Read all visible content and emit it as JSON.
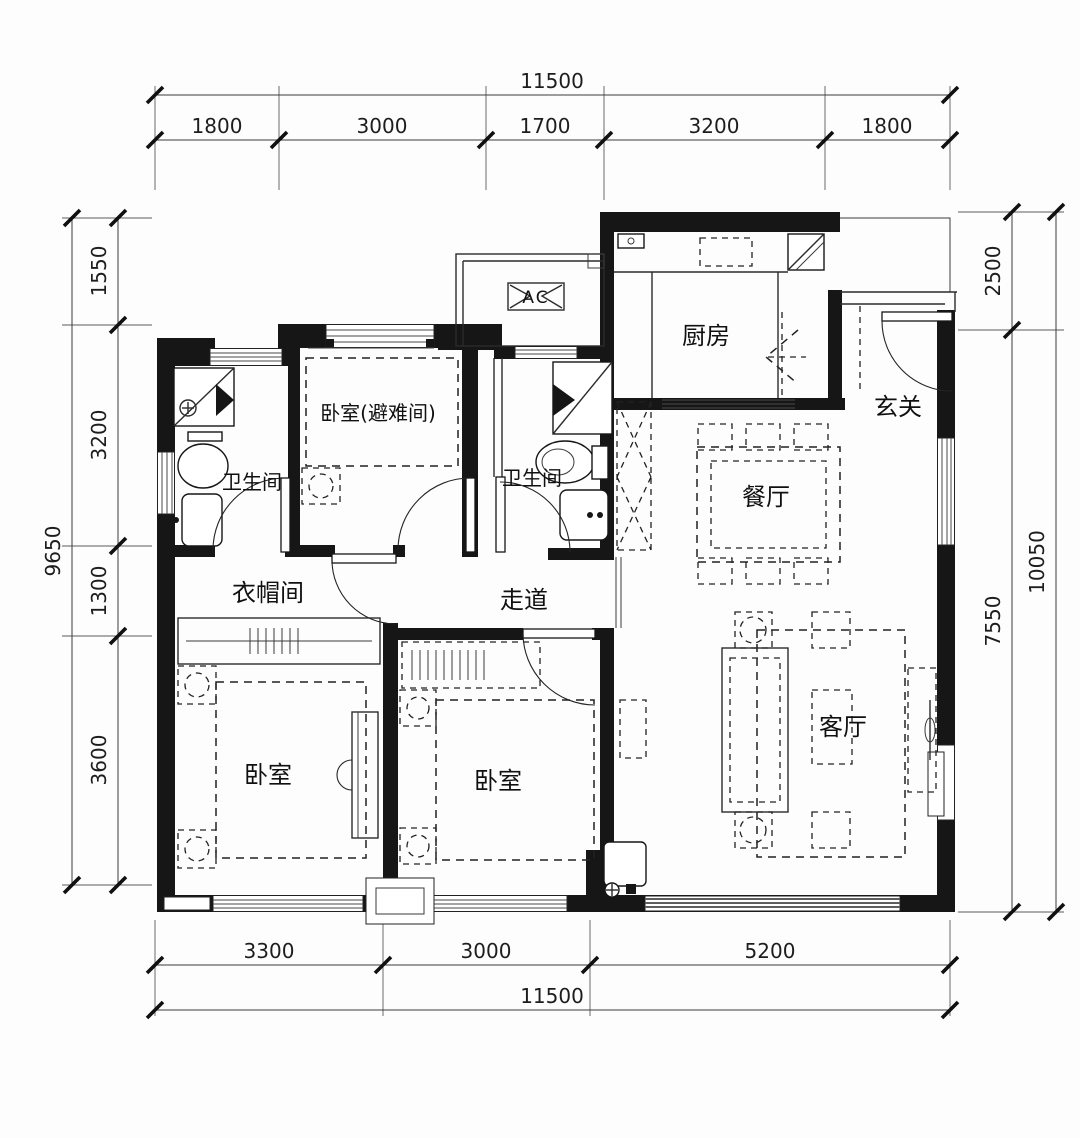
{
  "title": "户型图",
  "rooms": {
    "kitchen": "厨房",
    "foyer": "玄关",
    "dining": "餐厅",
    "living": "客厅",
    "bedroom_refuge": "卧室(避难间)",
    "bath_left": "卫生间",
    "bath_center": "卫生间",
    "cloakroom": "衣帽间",
    "corridor": "走道",
    "bedroom_left": "卧室",
    "bedroom_center": "卧室",
    "ac_label": "AC"
  },
  "dims": {
    "top": {
      "total": "11500",
      "segments": [
        "1800",
        "3000",
        "1700",
        "3200",
        "1800"
      ]
    },
    "bottom": {
      "total": "11500",
      "segments": [
        "3300",
        "3000",
        "5200"
      ]
    },
    "left": {
      "total": "9650",
      "segments": [
        "1550",
        "3200",
        "1300",
        "3600"
      ]
    },
    "right": {
      "total": "10050",
      "segments": [
        "2500",
        "7550"
      ]
    }
  },
  "colors": {
    "wall": "#161616",
    "paper": "#fdfdfd",
    "line": "#2b2b2b"
  }
}
